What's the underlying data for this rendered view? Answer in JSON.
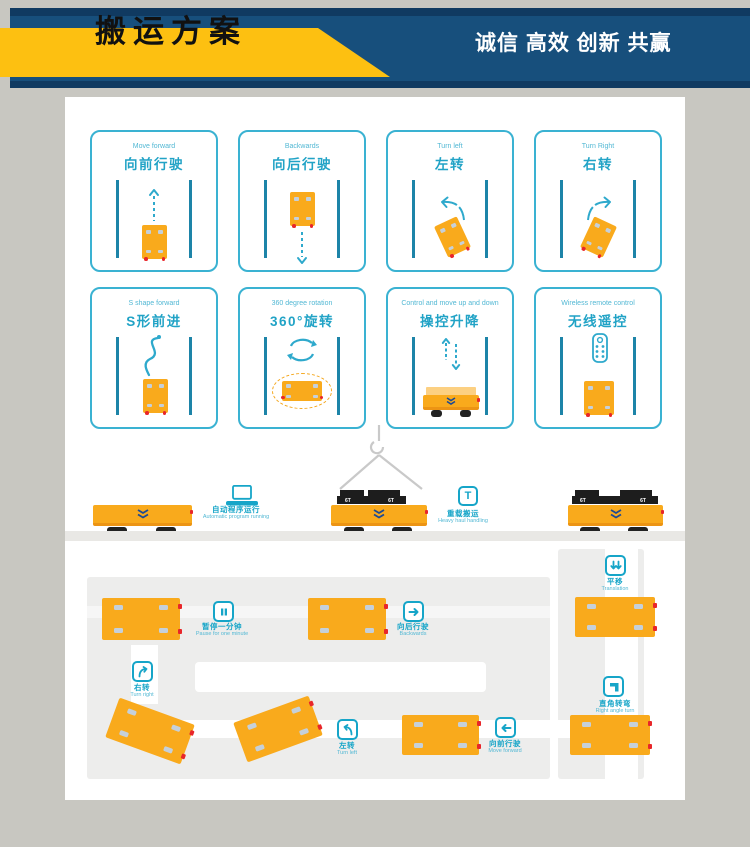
{
  "header": {
    "title": "搬运方案",
    "slogan": "诚信 高效 创新 共赢"
  },
  "colors": {
    "navy": "#174f7c",
    "banner_yellow": "#fdc011",
    "accent_teal": "#16a5c8",
    "vehicle_orange": "#f9aa1c",
    "red_dot": "#e8262a"
  },
  "cards": [
    {
      "en": "Move forward",
      "zh": "向前行驶"
    },
    {
      "en": "Backwards",
      "zh": "向后行驶"
    },
    {
      "en": "Turn left",
      "zh": "左转"
    },
    {
      "en": "Turn Right",
      "zh": "右转"
    },
    {
      "en": "S shape forward",
      "zh": "S形前进"
    },
    {
      "en": "360 degree rotation",
      "zh": "360°旋转"
    },
    {
      "en": "Control and move up and down",
      "zh": "操控升降"
    },
    {
      "en": "Wireless remote control",
      "zh": "无线遥控"
    }
  ],
  "middle": {
    "auto": {
      "zh": "自动程序运行",
      "en": "Automatic program running"
    },
    "heavy": {
      "zh": "重载搬运",
      "en": "Heavy haul handling",
      "icon_letter": "T"
    },
    "load_label": "6T"
  },
  "track": {
    "pause": {
      "zh": "暂停一分钟",
      "en": "Pause for one minute"
    },
    "backwards": {
      "zh": "向后行驶",
      "en": "Backwards"
    },
    "translation": {
      "zh": "平移",
      "en": "Translation"
    },
    "right_angle": {
      "zh": "直角转弯",
      "en": "Right angle turn"
    },
    "turn_right": {
      "zh": "右转",
      "en": "Turn right"
    },
    "turn_left": {
      "zh": "左转",
      "en": "Turn left"
    },
    "forward": {
      "zh": "向前行驶",
      "en": "Move forward"
    }
  }
}
